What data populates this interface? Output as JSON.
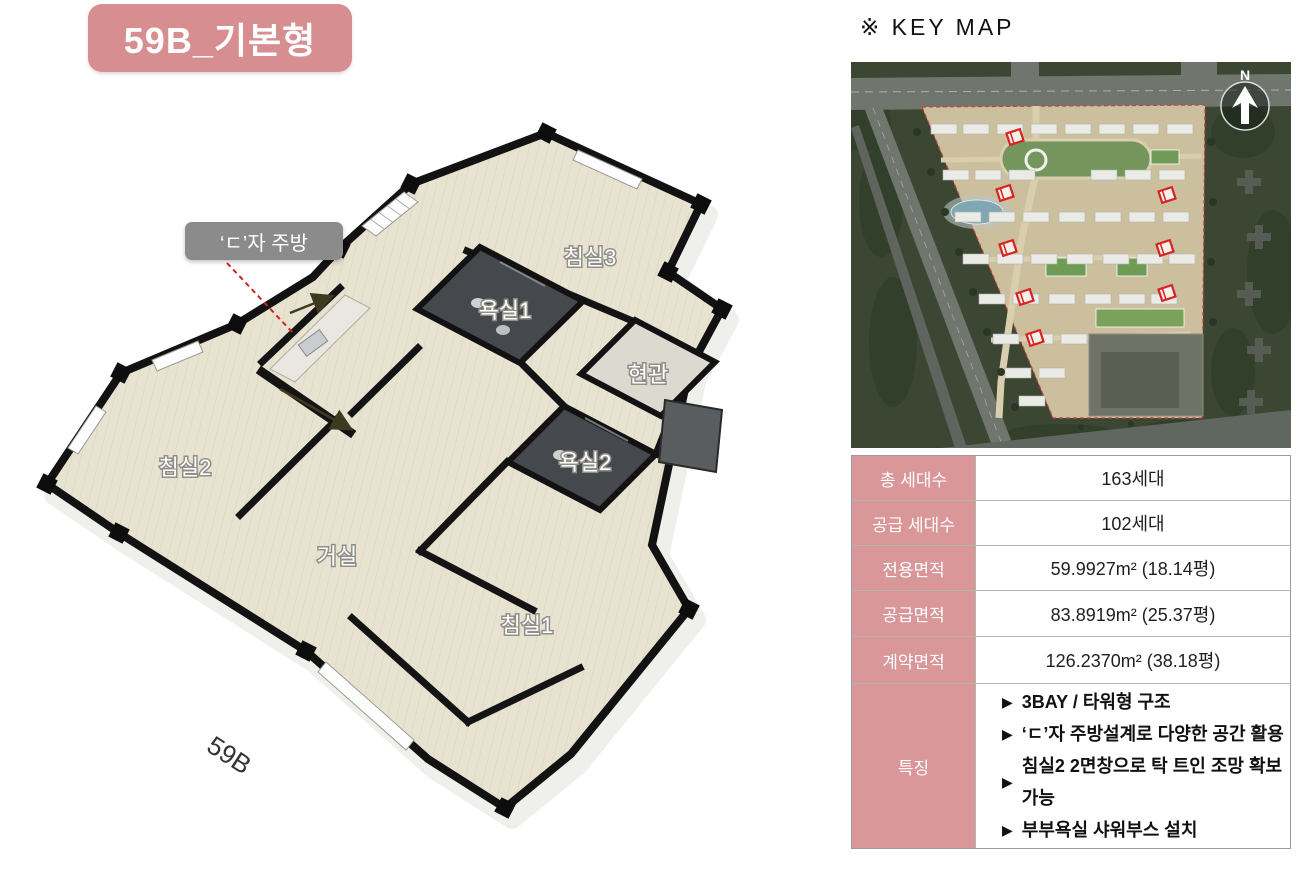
{
  "title_badge": {
    "label": "59B_기본형",
    "bg": "#d68e90",
    "text_color": "#ffffff"
  },
  "floor_plan": {
    "unit_label": "59B",
    "callout": {
      "label": "‘ㄷ’자 주방"
    },
    "rooms": [
      {
        "id": "bedroom2",
        "label": "침실2"
      },
      {
        "id": "bedroom3",
        "label": "침실3"
      },
      {
        "id": "bathroom1",
        "label": "욕실1"
      },
      {
        "id": "bathroom2",
        "label": "욕실2"
      },
      {
        "id": "entrance",
        "label": "현관"
      },
      {
        "id": "living",
        "label": "거실"
      },
      {
        "id": "bedroom1",
        "label": "침실1"
      }
    ]
  },
  "key_map": {
    "title": "※ KEY MAP",
    "north_label": "N",
    "marker_color": "#d92222"
  },
  "spec_table": {
    "header_bg": "#d9979a",
    "rows": [
      {
        "label": "총 세대수",
        "value": "163세대"
      },
      {
        "label": "공급 세대수",
        "value": "102세대"
      },
      {
        "label": "전용면적",
        "value": "59.9927m² (18.14평)"
      },
      {
        "label": "공급면적",
        "value": "83.8919m² (25.37평)"
      },
      {
        "label": "계약면적",
        "value": "126.2370m² (38.18평)"
      }
    ],
    "features": {
      "label": "특징",
      "bullet": "▶",
      "items": [
        "3BAY / 타워형 구조",
        "‘ㄷ’자 주방설계로 다양한 공간 활용",
        "침실2 2면창으로 탁 트인 조망 확보 가능",
        "부부욕실 샤워부스 설치"
      ]
    }
  }
}
